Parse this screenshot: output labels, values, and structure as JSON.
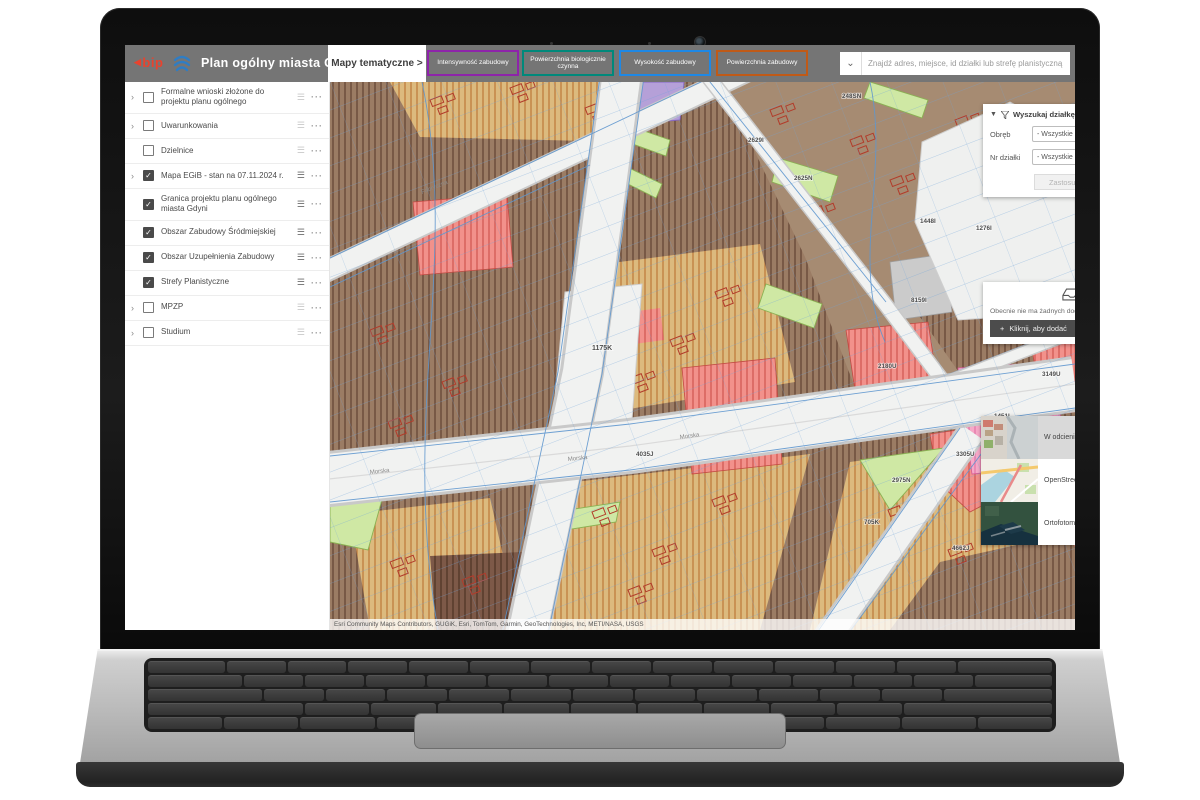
{
  "header": {
    "bip_logo": "bip",
    "app_title": "Plan ogólny miasta Gdyni",
    "thematic_button": "Mapy tematyczne >",
    "thematic_maps": [
      {
        "label": "Intensywność zabudowy",
        "accent": "#8e24aa"
      },
      {
        "label": "Powierzchnia biologicznie czynna",
        "accent": "#00897b"
      },
      {
        "label": "Wysokość zabudowy",
        "accent": "#1e88e5"
      },
      {
        "label": "Powierzchnia zabudowy",
        "accent": "#c05a17"
      }
    ],
    "search": {
      "placeholder": "Znajdź adres, miejsce, id działki lub strefę planistyczną"
    }
  },
  "layer_list": {
    "items": [
      {
        "label": "Formalne wnioski złożone do projektu planu ogólnego",
        "checked": false,
        "expandable": true
      },
      {
        "label": "Uwarunkowania",
        "checked": false,
        "expandable": true
      },
      {
        "label": "Dzielnice",
        "checked": false,
        "expandable": false
      },
      {
        "label": "Mapa EGiB - stan na 07.11.2024 r.",
        "checked": true,
        "expandable": true
      },
      {
        "label": "Granica projektu planu ogólnego miasta Gdyni",
        "checked": true,
        "expandable": false
      },
      {
        "label": "Obszar Zabudowy Śródmiejskiej",
        "checked": true,
        "expandable": false
      },
      {
        "label": "Obszar Uzupełnienia Zabudowy",
        "checked": true,
        "expandable": false
      },
      {
        "label": "Strefy Planistyczne",
        "checked": true,
        "expandable": false
      },
      {
        "label": "MPZP",
        "checked": false,
        "expandable": true
      },
      {
        "label": "Studium",
        "checked": false,
        "expandable": true
      }
    ]
  },
  "parcel_search_panel": {
    "title": "Wyszukaj działkę (stan na",
    "fields": [
      {
        "label": "Obręb",
        "value": "- Wszystkie"
      },
      {
        "label": "Nr działki",
        "value": "- Wszystkie"
      }
    ],
    "apply_button": "Zastosuj"
  },
  "add_panel": {
    "message": "Obecnie nie ma żadnych dodatków",
    "button": "Kliknij, aby dodać"
  },
  "basemap_panel": {
    "items": [
      {
        "label": "W odcieniach szarości",
        "selected": true
      },
      {
        "label": "OpenStreetMap",
        "selected": false
      },
      {
        "label": "Ortofotomapa",
        "selected": false
      }
    ]
  },
  "map": {
    "attribution": "Esri Community Maps Contributors, GUGiK, Esri, TomTom, Garmin, GeoTechnologies, Inc, METI/NASA, USGS",
    "parcel_labels": [
      "248SN",
      "2625N",
      "2629I",
      "1175K",
      "1448I",
      "1276I",
      "8159I",
      "3149U",
      "2180U",
      "1451I",
      "4035J",
      "2975N",
      "705K",
      "3305U",
      "4662J"
    ],
    "street_labels": [
      "Fabryczna",
      "Morska",
      "Morska",
      "Morska"
    ],
    "colors": {
      "road": "#f1f2f1",
      "parcel_brown": "#9b7c64",
      "parcel_tan": "#dcba7e",
      "parcel_red": "#f2918b",
      "parcel_pink": "#f6a9c8",
      "parcel_green": "#cfe8a4",
      "parcel_purple": "#b5a0d8",
      "cadastre_line": "#5f97cf",
      "building_outline": "#b23b2a"
    }
  }
}
